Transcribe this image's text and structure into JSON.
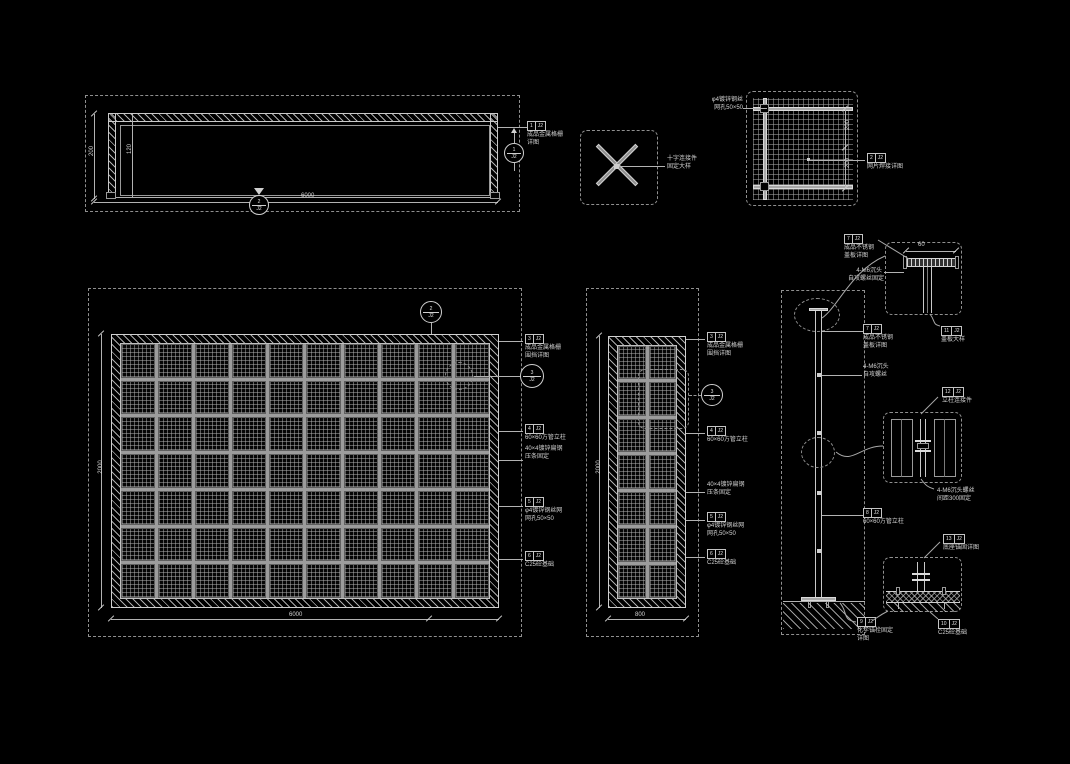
{
  "colors": {
    "background": "#000000",
    "line": "#b9b9b9",
    "text": "#d2d2d2"
  },
  "plan": {
    "width_dim": "6000",
    "depth_dim": "200",
    "inner_dim": "120",
    "cut_marker": {
      "top": "2",
      "bottom": "J2"
    },
    "side_marker": {
      "top": "1",
      "bottom": "J2"
    },
    "callout": {
      "no": "1",
      "sheet": "J2",
      "line1": "成品金属格栅",
      "line2": "详图"
    }
  },
  "cross_detail": {
    "line1": "十字连接件",
    "line2": "固定大样"
  },
  "mesh_detail": {
    "left_line1": "φ4镀锌钢丝",
    "left_line2": "网孔50×50",
    "dim1": "200",
    "dim2": "200",
    "callout": {
      "no": "2",
      "sheet": "J2",
      "line1": "网片焊接详图"
    }
  },
  "front_elev": {
    "height_dim": "2000",
    "width_dim": "6000",
    "grid": "7x10",
    "top_bubble": {
      "top": "2",
      "bottom": "J2"
    },
    "side_bubble": {
      "top": "3",
      "bottom": "J2"
    },
    "callout1": {
      "no": "3",
      "sheet": "J2",
      "line1": "成品金属格栅",
      "line2": "围挡详图"
    },
    "callout2": {
      "no": "4",
      "sheet": "J2",
      "line1": "60×60方管立柱"
    },
    "callout3": {
      "line1": "40×4镀锌扁钢",
      "line2": "压条固定"
    },
    "callout4": {
      "no": "5",
      "sheet": "J2",
      "line1": "φ4镀锌钢丝网",
      "line2": "网孔50×50"
    },
    "callout5": {
      "no": "6",
      "sheet": "J2",
      "line1": "C25砼基础"
    }
  },
  "side_elev": {
    "height_dim": "2000",
    "width_dim": "800",
    "grid": "7x2",
    "bubble": {
      "top": "3",
      "bottom": "J2"
    },
    "callout1": {
      "no": "3",
      "sheet": "J2",
      "line1": "成品金属格栅",
      "line2": "围挡详图"
    },
    "callout2": {
      "no": "4",
      "sheet": "J2",
      "line1": "60×60方管立柱"
    },
    "callout3": {
      "line1": "40×4镀锌扁钢",
      "line2": "压条固定"
    },
    "callout4": {
      "no": "5",
      "sheet": "J2",
      "line1": "φ4镀锌钢丝网",
      "line2": "网孔50×50"
    },
    "callout5": {
      "no": "6",
      "sheet": "J2",
      "line1": "C25砼基础"
    }
  },
  "section": {
    "callout1": {
      "no": "7",
      "sheet": "J2",
      "line1": "成品不锈钢",
      "line2": "盖板详图"
    },
    "callout2": {
      "line1": "4-M6沉头",
      "line2": "自攻螺丝"
    },
    "callout3": {
      "no": "8",
      "sheet": "J2",
      "line1": "60×60方管立柱"
    },
    "base_callout": {
      "no": "9",
      "sheet": "J2",
      "line1": "化学锚栓固定",
      "line2": "详图"
    },
    "foundation_callout": {
      "no": "10",
      "sheet": "J2",
      "line1": "C25砼基础"
    }
  },
  "detail_top": {
    "callout": {
      "no": "7",
      "sheet": "J2",
      "line1": "成品不锈钢",
      "line2": "盖板详图"
    },
    "screw_line1": "4-M6沉头",
    "screw_line2": "自攻螺丝固定",
    "dim": "60",
    "bottom_callout": {
      "no": "11",
      "sheet": "J2",
      "line1": "盖板大样"
    }
  },
  "detail_mid": {
    "callout": {
      "no": "12",
      "sheet": "J2",
      "line1": "立柱连接件"
    },
    "note_line1": "4-M6沉头螺丝",
    "note_line2": "间距300固定"
  },
  "detail_base": {
    "callout": {
      "no": "13",
      "sheet": "J2",
      "line1": "底座锚固详图"
    }
  }
}
